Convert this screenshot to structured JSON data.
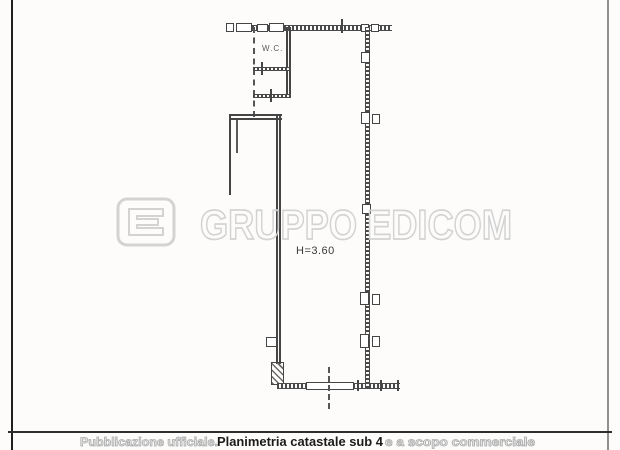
{
  "document": {
    "kind": "scanned cadastral floor plan page",
    "background_color": "#fdfcfb",
    "line_color": "#454545"
  },
  "plan": {
    "wc_label": "W.C.",
    "height_label": "H=3.60"
  },
  "watermark": {
    "logo": "edicom-logo",
    "text": "GRUPPO EDICOM",
    "color": "#d3d3d3"
  },
  "footer": {
    "left_text": "Pubblicazione ufficiale.",
    "title": "Planimetria catastale sub 4",
    "right_text": "e a scopo commerciale",
    "gray_color": "#ababab",
    "title_color": "#1b1b1b"
  }
}
